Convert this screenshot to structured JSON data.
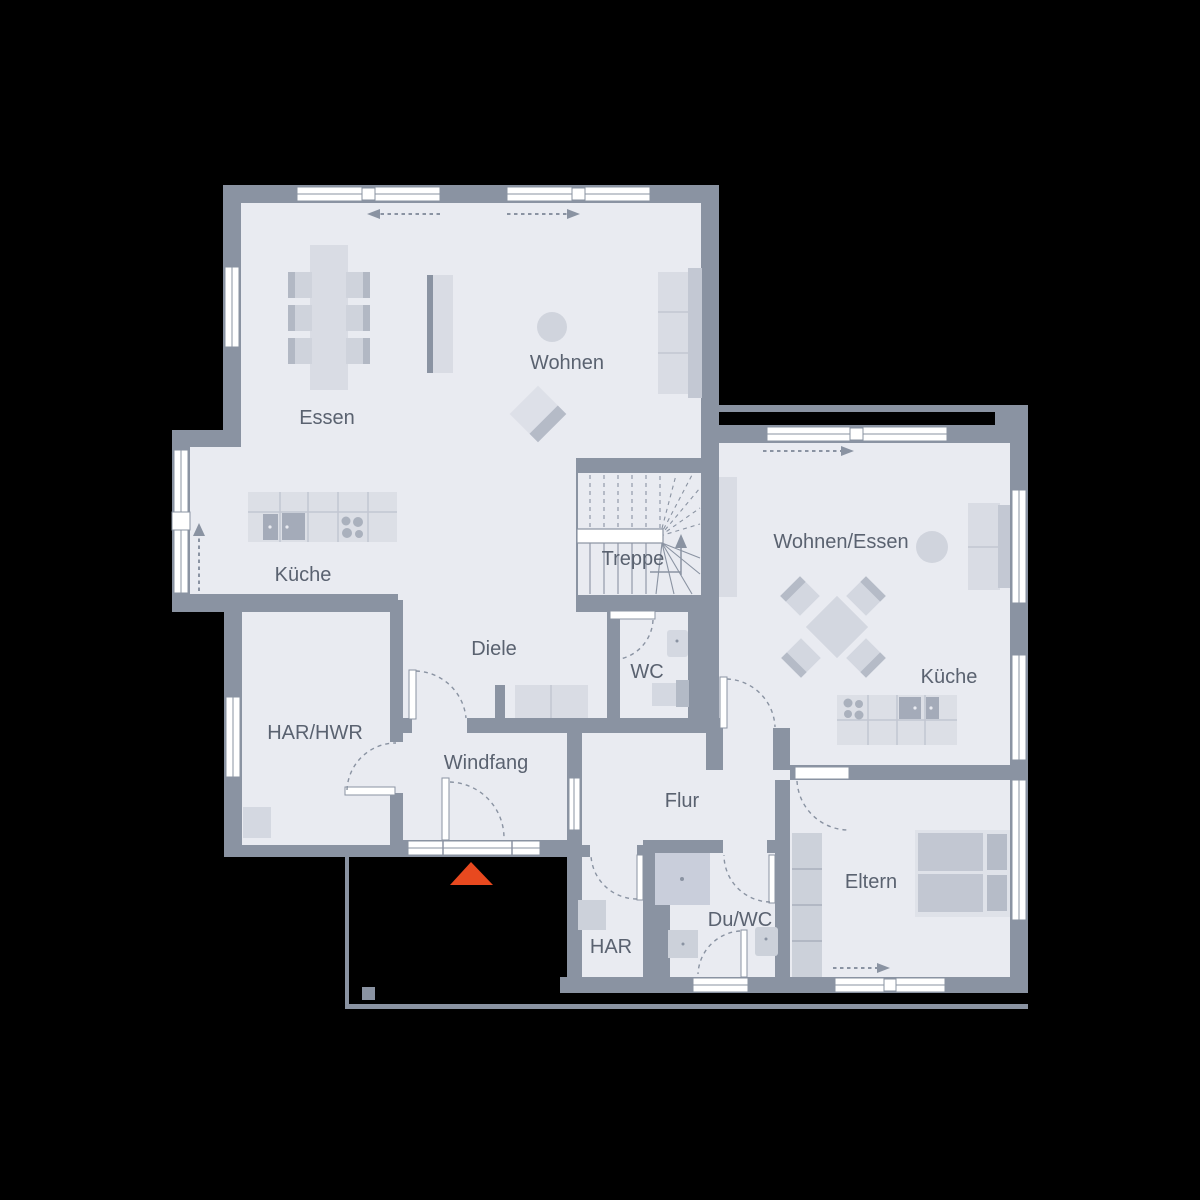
{
  "title": "Grundriss Erdgeschoss",
  "colors": {
    "background": "#000000",
    "wall": "#8a93a2",
    "floor": "#e9ebf1",
    "furniture_light": "#d9dce4",
    "furniture_mid": "#c6cbd5",
    "furniture_dark": "#b2b8c4",
    "appliance": "#a4abb9",
    "label_text": "#5a6270",
    "entrance_marker": "#e8491f"
  },
  "rooms": [
    {
      "id": "essen",
      "label": "Essen"
    },
    {
      "id": "wohnen",
      "label": "Wohnen"
    },
    {
      "id": "kueche-links",
      "label": "Küche"
    },
    {
      "id": "treppe",
      "label": "Treppe"
    },
    {
      "id": "diele",
      "label": "Diele"
    },
    {
      "id": "wc",
      "label": "WC"
    },
    {
      "id": "har-hwr",
      "label": "HAR/HWR"
    },
    {
      "id": "windfang",
      "label": "Windfang"
    },
    {
      "id": "flur",
      "label": "Flur"
    },
    {
      "id": "wohnen-essen",
      "label": "Wohnen/Essen"
    },
    {
      "id": "kueche-rechts",
      "label": "Küche"
    },
    {
      "id": "eltern",
      "label": "Eltern"
    },
    {
      "id": "du-wc",
      "label": "Du/WC"
    },
    {
      "id": "har",
      "label": "HAR"
    }
  ],
  "markers": {
    "entrance_triangle": "main entrance",
    "stair_direction": "up",
    "sliding_door_arrows": [
      "left",
      "right",
      "right",
      "right"
    ],
    "terrace_arrow": "up"
  }
}
